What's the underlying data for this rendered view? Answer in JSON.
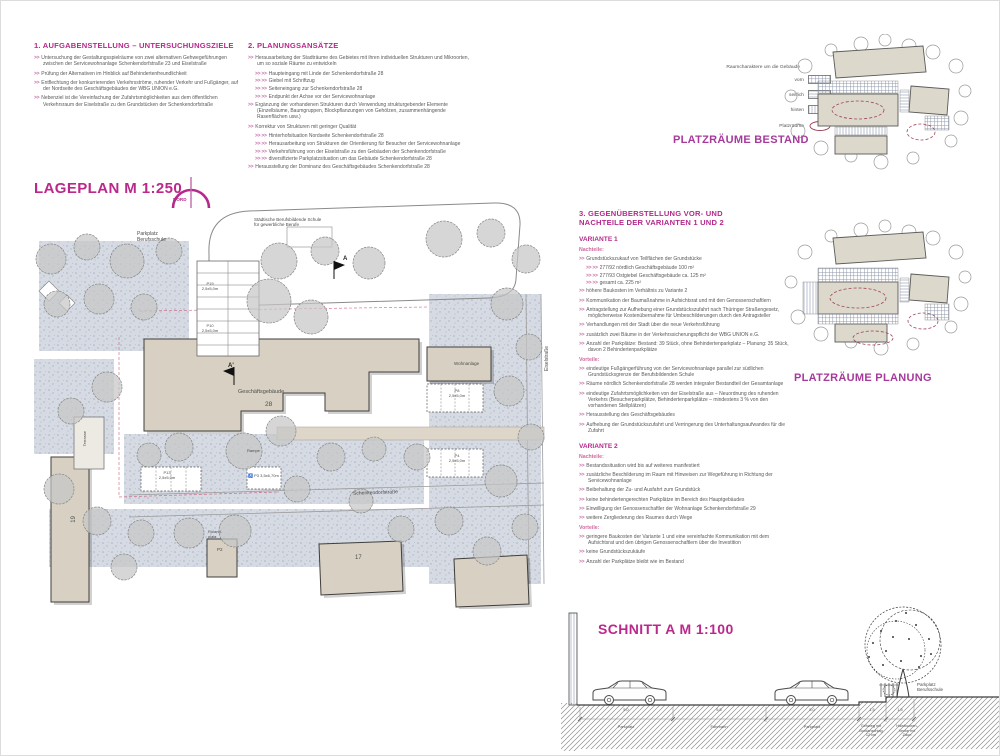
{
  "colors": {
    "accent": "#b5298c",
    "body_text": "#58595b",
    "building": "#d8d1c3",
    "paving": "#d5dae3",
    "platz_ellipse": "#a04458"
  },
  "header1": {
    "title": "1. AUFGABENSTELLUNG – UNTERSUCHUNGSZIELE",
    "items": [
      {
        "m": ">>",
        "t": "Untersuchung der Gestaltungsspielräume von zwei alternativen Gehwegeführungen zwischen der Servicewohnanlage Schenkendorfstraße 23 und Eiselstraße"
      },
      {
        "m": ">>",
        "t": "Prüfung der Alternativen im Hinblick auf Behindertenfreundlichkeit"
      },
      {
        "m": ">>",
        "t": "Entflechtung der konkurrierenden Verkehrsströme, ruhender Verkehr und Fußgänger, auf der Nordseite des Geschäftsgebäudes der WBG UNION e.G."
      },
      {
        "m": ">>",
        "t": "Nebenziel ist die Vereinfachung der Zufahrtsmöglichkeiten aus dem öffentlichen Verkehrsraum der Eiselstraße zu den Grundstücken der Schenkendorfstraße"
      }
    ]
  },
  "header2": {
    "title": "2. PLANUNGSANSÄTZE",
    "items": [
      {
        "m": ">>",
        "t": "Herausarbeitung der Stadträume des Gebietes mit ihren individuellen Strukturen und Mikroorten, um so soziale Räume zu entwickeln"
      },
      {
        "m": ">> >>",
        "t": "Haupteingang mit Linde der Schenkendorfstraße 28"
      },
      {
        "m": ">> >>",
        "t": "Giebel mit Schriftzug"
      },
      {
        "m": ">> >>",
        "t": "Seiteneingang zur Schenkendorfstraße 28"
      },
      {
        "m": ">> >>",
        "t": "Endpunkt der Achse vor der Servicewohnanlage"
      },
      {
        "m": ">>",
        "t": "Ergänzung der vorhandenen Strukturen durch Verwendung strukturgebender Elemente (Einzelbäume, Baumgruppen, Blockpflanzungen von Gehölzen, zusammenhängende Rasenflächen usw.)"
      },
      {
        "m": ">>",
        "t": "Korrektur von Strukturen mit geringer Qualität"
      },
      {
        "m": ">> >>",
        "t": "Hinterhofsituation Nordseite Schenkendorfstraße 28"
      },
      {
        "m": ">> >>",
        "t": "Herausarbeitung von Strukturen der Orientierung für Besucher der Servicewohnanlage"
      },
      {
        "m": ">> >>",
        "t": "Verkehrsführung von der Eiselstraße zu den Gebäuden der Schenkendorfstraße"
      },
      {
        "m": ">> >>",
        "t": "diversifizierte Parkplatzsituation um das Gebäude Schenkendorfstraße 28"
      },
      {
        "m": ">>",
        "t": "Herausstellung der Dominanz des Geschäftsgebäudes Schenkendorfstraße 28"
      }
    ]
  },
  "legend": {
    "title": "Raumcharaktere um die Gebäude",
    "items": [
      {
        "label": "vorn",
        "swatch": "grid-hatch"
      },
      {
        "label": "seitlich",
        "swatch": "horizontal-lines"
      },
      {
        "label": "hinten",
        "swatch": "vertical-lines"
      },
      {
        "label": "Platzräume",
        "swatch": "ellipse"
      }
    ]
  },
  "diagram_bestand": {
    "label": "PLATZRÄUME BESTAND"
  },
  "diagram_planung": {
    "label": "PLATZRÄUME PLANUNG"
  },
  "lageplan": {
    "title": "LAGEPLAN  M 1:250",
    "north": "NORD",
    "labels": {
      "school": "Städtische Berufsbildende Schule\nfür gewerbliche Berufe",
      "parkplatz_schule": "Parkplatz\nBerufsschule",
      "geschaeftsgebaeude": "Geschäftsgebäude",
      "hausnummer_28": "28",
      "hausnummer_17": "17",
      "hausnummer_19": "19",
      "p19": "P19\n2,5x5,0m",
      "p10": "P10\n2,5x5,0m",
      "p13": "P13\n2,5x5,0m",
      "p8": "P8\n2,5x5,0m",
      "p4": "P4\n2,5x5,0m",
      "p3": "P3  3,5x6,70m",
      "p2": "P2",
      "wheelchair": "♿",
      "terrasse": "Terrasse",
      "rampe": "Rampe",
      "rolandplatz": "Roland-\nplatz",
      "wohnanlage": "Wohnanlage",
      "schenkendorfstrasse": "Schenkendorfstraße",
      "eiselstrasse": "Eiselstraße",
      "marker_a": "A",
      "marker_a_prime": "A'"
    }
  },
  "section3": {
    "title": "3. GEGENÜBERSTELLUNG VOR- UND NACHTEILE DER VARIANTEN 1 UND 2",
    "variante1": {
      "label": "VARIANTE 1",
      "nachteile_label": "Nachteile:",
      "vorteile_label": "Vorteile:",
      "nachteile": [
        {
          "m": ">>",
          "t": "Grundstückszukauf von Teilflächen der Grundstücke"
        },
        {
          "m": ">> >>",
          "t": "277/92 nördlich Geschäftsgebäude  100 m²"
        },
        {
          "m": ">> >>",
          "t": "277/93 Ostgiebel Geschäftsgebäude  ca. 125 m²"
        },
        {
          "m": ">> >>",
          "t": "gesamt ca. 225 m²"
        },
        {
          "m": ">>",
          "t": "höhere Baukosten im Verhältnis zu Variante 2"
        },
        {
          "m": ">>",
          "t": "Kommunikation der Baumaßnahme in Aufsichtsrat und mit den Genossenschaftlern"
        },
        {
          "m": ">>",
          "t": "Antragstellung zur Aufhebung einer Grundstückszufahrt nach Thüringer Straßengesetz, möglicherweise Kostenübernahme für Umbeschilderungen durch den Antragsteller"
        },
        {
          "m": ">>",
          "t": "Verhandlungen mit der Stadt über die neue Verkehrsführung"
        },
        {
          "m": ">>",
          "t": "zusätzlich zwei Bäume in der Verkehrssicherungspflicht der WBG UNION e.G."
        },
        {
          "m": ">>",
          "t": "Anzahl der Parkplätze: Bestand: 39 Stück, ohne Behindertenparkplatz – Planung: 35 Stück, davon 2 Behindertenparkplätze"
        }
      ],
      "vorteile": [
        {
          "m": ">>",
          "t": "eindeutige Fußgängerführung von der Servicewohnanlage parallel zur südlichen Grundstücksgrenze der Berufsbildenden Schule"
        },
        {
          "m": ">>",
          "t": "Räume nördlich Schenkendorfstraße 28 werden integraler Bestandteil der Gesamtanlage"
        },
        {
          "m": ">>",
          "t": "eindeutige Zufahrtsmöglichkeiten von der Eiselstraße aus – Neuordnung des ruhenden Verkehrs (Besucherparkplätze, Behindertenparkplätze – mindestens 3 % von den vorhandenen Stellplätzen)"
        },
        {
          "m": ">>",
          "t": "Herausstellung des Geschäftsgebäudes"
        },
        {
          "m": ">>",
          "t": "Aufhebung der Grundstückszufahrt und Verringerung des Unterhaltungsaufwandes für die Zufahrt"
        }
      ]
    },
    "variante2": {
      "label": "VARIANTE 2",
      "nachteile_label": "Nachteile:",
      "vorteile_label": "Vorteile:",
      "nachteile": [
        {
          "m": ">>",
          "t": "Bestandssituation wird bis auf weiteres manifestiert"
        },
        {
          "m": ">>",
          "t": "zusätzliche Beschilderung im Raum mit Hinweisen zur Wegeführung in Richtung der Servicewohnanlage"
        },
        {
          "m": ">>",
          "t": "Beibehaltung der Zu- und Ausfahrt zum Grundstück"
        },
        {
          "m": ">>",
          "t": "keine behindertengerechten Parkplätze im Bereich des Hauptgebäudes"
        },
        {
          "m": ">>",
          "t": "Einwilligung der Genossenschaftler der Wohnanlage Schenkendorfstraße 29"
        },
        {
          "m": ">>",
          "t": "weitere Zergliederung des Raumes durch Wege"
        }
      ],
      "vorteile": [
        {
          "m": ">>",
          "t": "geringere Baukosten der Variante 1 und eine vereinfachte Kommunikation mit dem Aufsichtsrat und den übrigen Genossenschaftlern über die Investition"
        },
        {
          "m": ">>",
          "t": "keine Grundstückszukäufe"
        },
        {
          "m": ">>",
          "t": "Anzahl der Parkplätze bleibt wie im Bestand"
        }
      ]
    }
  },
  "schnitt": {
    "title": "SCHNITT A  M 1:100",
    "dimensions": [
      "5,0",
      "5,5",
      "5,0",
      "1,5",
      "1,5"
    ],
    "segment_labels": [
      "Parkplatz",
      "Fahrbahn",
      "Parkplatz",
      "Gehweg mit\nBordanschlag\n12 cm",
      "Hainbuchen-\nhecke mit\nZaun"
    ],
    "right_label": "Parkplatz\nBerufsschule"
  }
}
